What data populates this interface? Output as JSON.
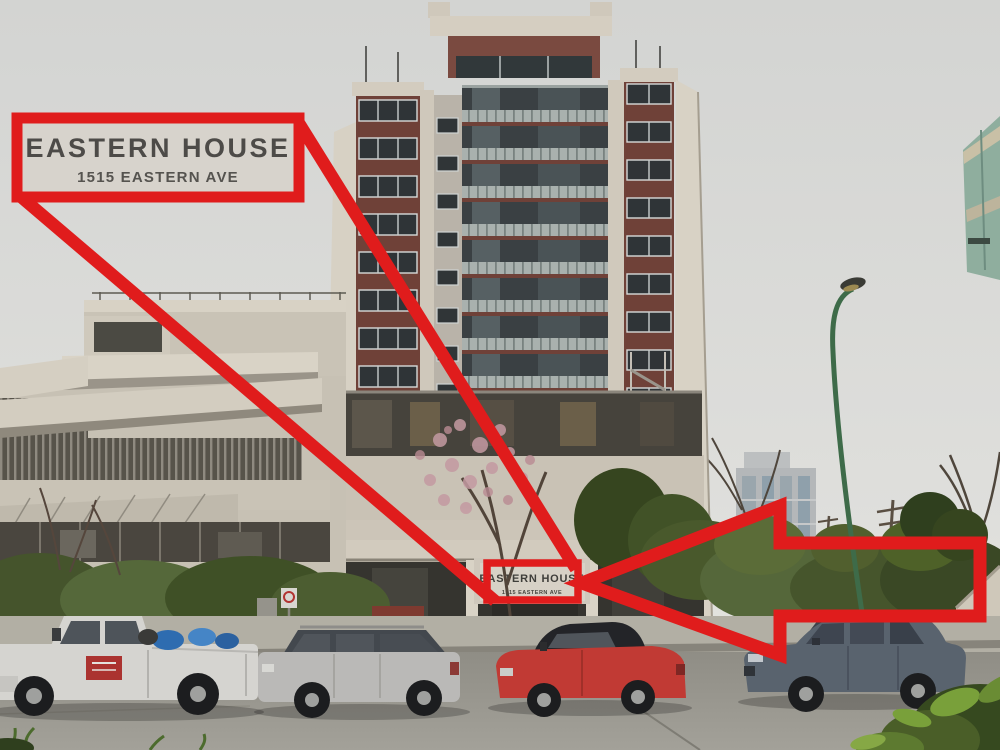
{
  "annotation": {
    "accent_color": "#e01c1c",
    "callout_box": {
      "title": "EASTERN HOUSE",
      "subtitle": "1515 EASTERN AVE"
    },
    "building_sign": {
      "title": "EASTERN HOUSE",
      "subtitle": "1515 EASTERN AVE"
    }
  },
  "scene": {
    "colors": {
      "sky": "#d8d9d6",
      "tower_beige": "#d3ccbf",
      "tower_maroon": "#6f4138",
      "podium_concrete": "#c7c1b4",
      "hedge_green": "#4d5e33",
      "road_asphalt": "#98968e",
      "lamp_pole_green": "#3e6b49",
      "truck_white": "#d5d4d0",
      "wagon_silver": "#bab9b7",
      "convertible_red": "#c13a34",
      "sedan_blue_gray": "#59636e"
    }
  }
}
